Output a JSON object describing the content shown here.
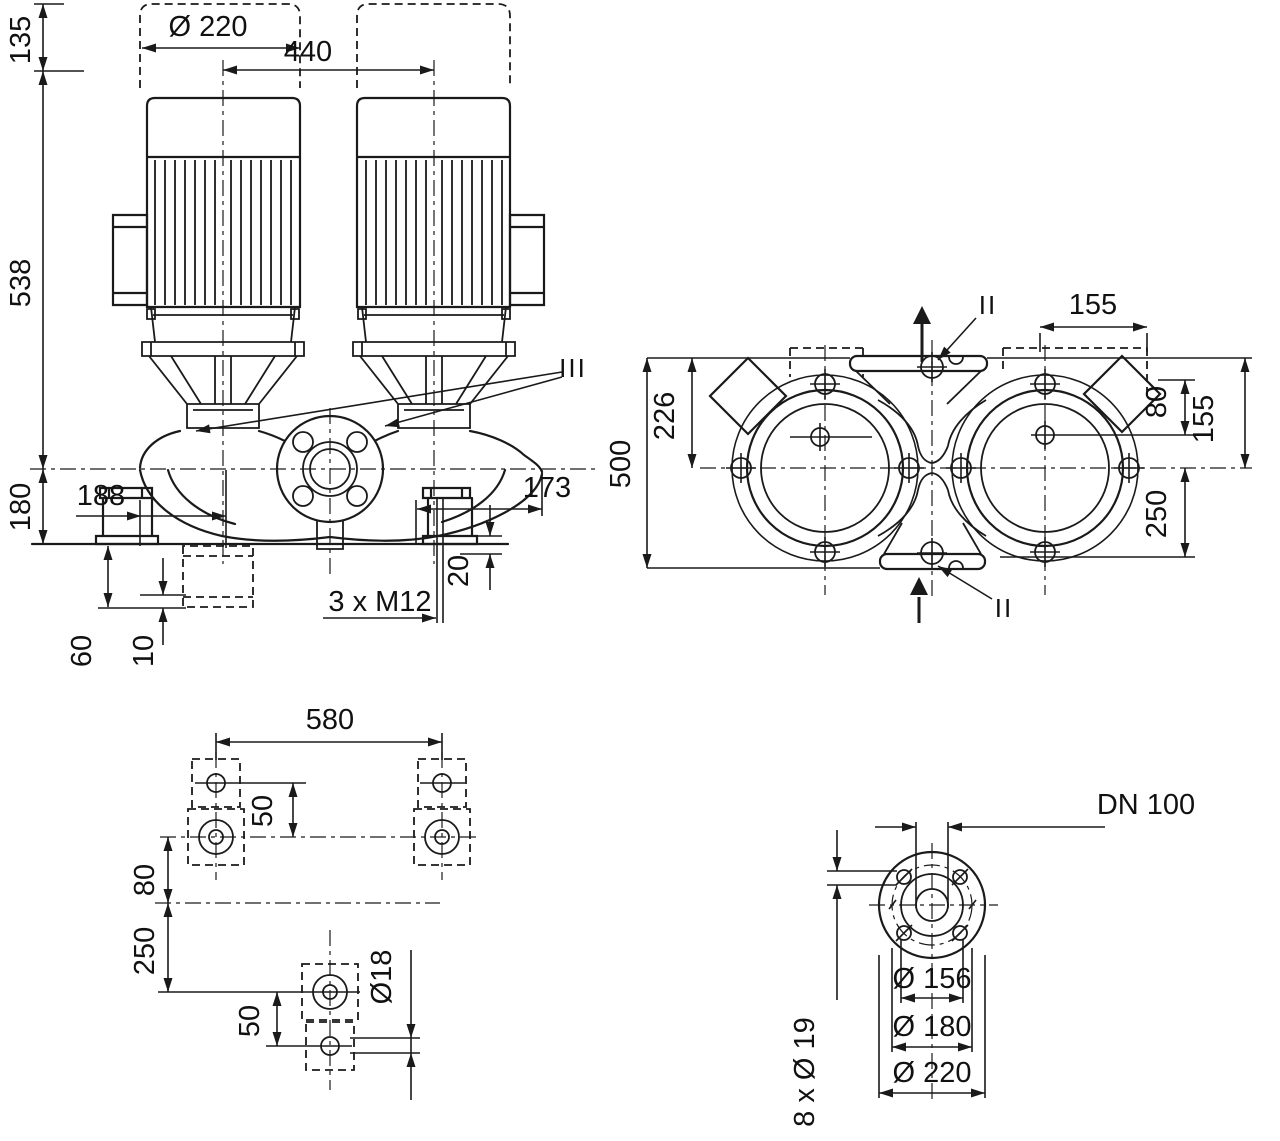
{
  "colors": {
    "background": "#ffffff",
    "ink": "#1a1a1a"
  },
  "views": {
    "front": {
      "clearance_height": "135",
      "motor_diameter": "Ø 220",
      "motor_spacing": "440",
      "height_above_axis": "538",
      "height_below_axis": "180",
      "offset_left": "188",
      "offset_right": "173",
      "pad_thickness": "20",
      "tapped_holes": "3 x M12",
      "foundation_depth": "60",
      "shim_thickness": "10",
      "section_mark": "III"
    },
    "plan": {
      "port_to_edge": "155",
      "section_mark_top": "II",
      "section_mark_bottom": "II",
      "axis_to_top": "226",
      "overall_width": "500",
      "terminal_offset": "80",
      "edge_offset": "155",
      "axis_to_port": "250"
    },
    "foundation": {
      "bolt_spacing": "580",
      "hole_offset_top": "50",
      "axis_offset": "80",
      "axis_to_bolt_row": "250",
      "hole_offset_bottom": "50",
      "hole_diameter": "Ø18"
    },
    "flange": {
      "nominal_diameter": "DN 100",
      "raised_face": "Ø 156",
      "bolt_circle": "Ø 180",
      "outer_diameter": "Ø 220",
      "bolt_holes": "8 x Ø 19"
    }
  }
}
